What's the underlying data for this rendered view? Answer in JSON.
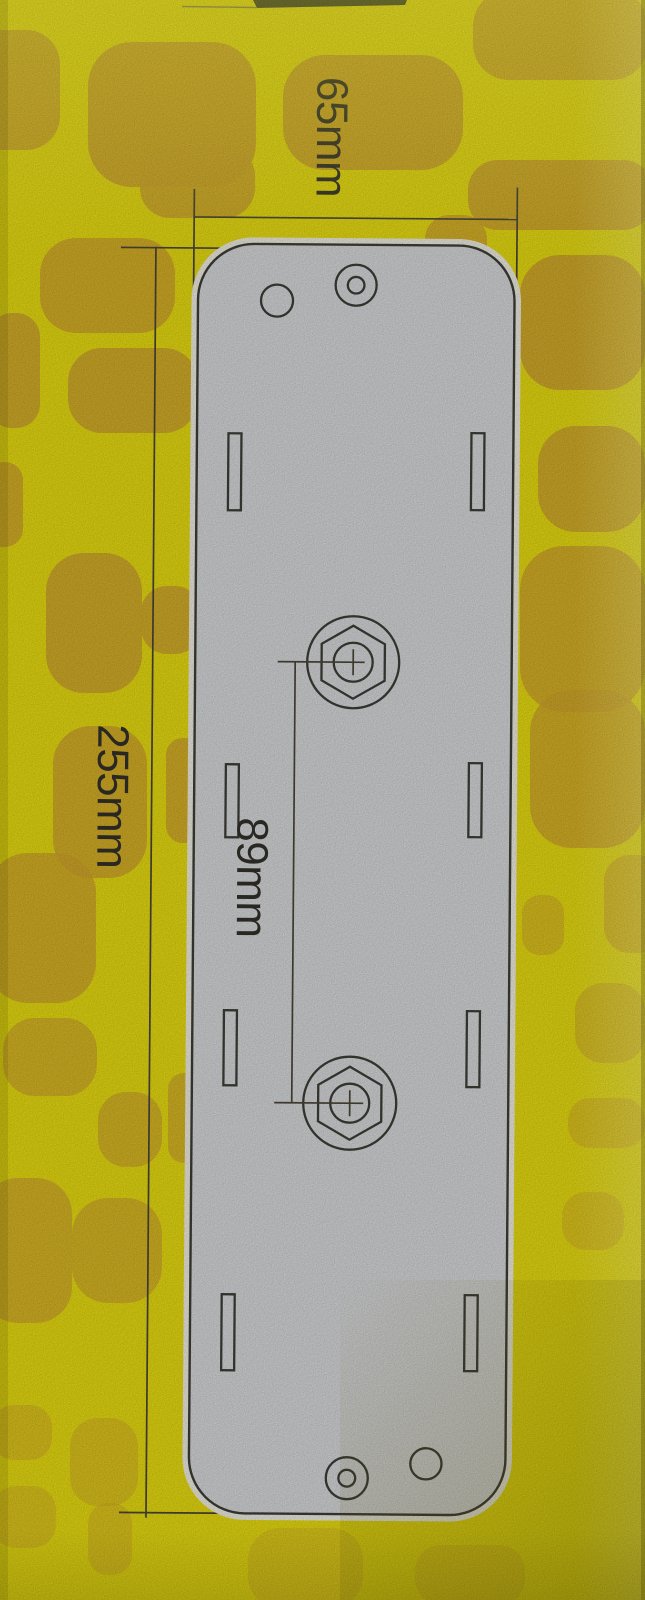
{
  "page": {
    "kind": "product packaging photograph",
    "content": "Technical dimension drawing of a flat rectangular mounting plate printed on yellow giraffe-pattern packaging"
  },
  "drawing": {
    "labels": {
      "width": "65mm",
      "height": "255mm",
      "hole_spacing": "89mm"
    },
    "plate": {
      "width_mm": 65,
      "height_mm": 255,
      "hex_bolt_spacing_mm": 89,
      "hex_bolts": 2,
      "mounting_slots": 8,
      "round_holes": 4
    }
  },
  "colors": {
    "background_yellow": "#e9dd12",
    "blob_orange": "#d2a82c",
    "plate_fill": "#d9dadc",
    "plate_halo": "#f1efe4",
    "outline_dark": "#3e3e38",
    "dim_line": "#4b4639",
    "label_text": "#33312b",
    "band_dark": "#3b3f26"
  }
}
